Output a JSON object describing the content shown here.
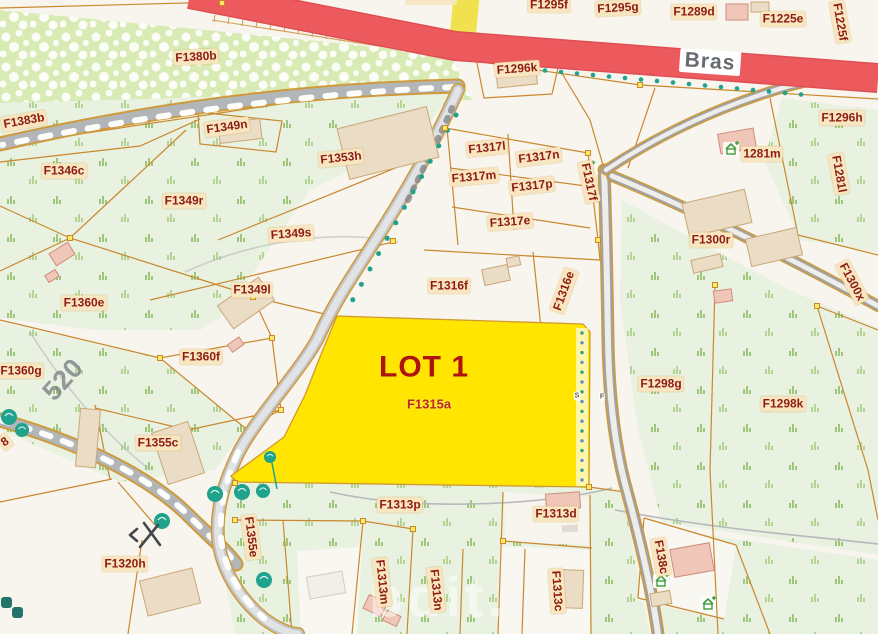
{
  "map": {
    "road_name": "Bras",
    "road_number": "520",
    "lot": {
      "title": "LOT 1",
      "parcel_id": "F1315a"
    },
    "watermark": "bdit.",
    "colors": {
      "lot_fill": "#ffe500",
      "road_major": "#ec5a5e",
      "road_minor_fill": "#d2d5d6",
      "parcel_line": "#c9882e",
      "label_text": "#8e1c12",
      "label_bg": "#f7e6c0",
      "tree": "#1fa38c",
      "grass_bg": "#e9f1e1",
      "orchard_bg": "#d8ebb4",
      "yellow_road": "#f2e14e"
    },
    "icon_names": [
      "tree-icon",
      "house-plus-icon",
      "windmill-icon",
      "survey-marker-icon"
    ],
    "labels": [
      {
        "t": "F1295f",
        "x": 549,
        "y": 5
      },
      {
        "t": "F1295g",
        "x": 618,
        "y": 8,
        "r": -3
      },
      {
        "t": "F1289d",
        "x": 694,
        "y": 12
      },
      {
        "t": "F1225e",
        "x": 783,
        "y": 19
      },
      {
        "t": "F1225f",
        "x": 840,
        "y": 22,
        "r": 80
      },
      {
        "t": "F1296k",
        "x": 517,
        "y": 69,
        "r": -4
      },
      {
        "t": "F1296h",
        "x": 842,
        "y": 118
      },
      {
        "t": "F1380b",
        "x": 196,
        "y": 57,
        "r": -3
      },
      {
        "t": "F1383b",
        "x": 24,
        "y": 121,
        "r": -10
      },
      {
        "t": "F1349n",
        "x": 227,
        "y": 127,
        "r": -8
      },
      {
        "t": "F1353h",
        "x": 341,
        "y": 158,
        "r": -6
      },
      {
        "t": "F1317l",
        "x": 487,
        "y": 148,
        "r": -6
      },
      {
        "t": "F1317n",
        "x": 539,
        "y": 157,
        "r": -7
      },
      {
        "t": "F1317m",
        "x": 474,
        "y": 177,
        "r": -5
      },
      {
        "t": "F1317p",
        "x": 532,
        "y": 186,
        "r": -6
      },
      {
        "t": "F1317f",
        "x": 589,
        "y": 182,
        "r": 78
      },
      {
        "t": "F1317e",
        "x": 510,
        "y": 222,
        "r": -4
      },
      {
        "t": "1281m",
        "x": 762,
        "y": 154
      },
      {
        "t": "F1281l",
        "x": 839,
        "y": 174,
        "r": 80
      },
      {
        "t": "F1300r",
        "x": 711,
        "y": 240
      },
      {
        "t": "F1300x",
        "x": 852,
        "y": 282,
        "r": 62
      },
      {
        "t": "F1346c",
        "x": 64,
        "y": 171
      },
      {
        "t": "F1349r",
        "x": 184,
        "y": 201
      },
      {
        "t": "F1349s",
        "x": 291,
        "y": 234,
        "r": -4
      },
      {
        "t": "F1349l",
        "x": 252,
        "y": 290
      },
      {
        "t": "F1360e",
        "x": 84,
        "y": 303
      },
      {
        "t": "F1360g",
        "x": 21,
        "y": 371
      },
      {
        "t": "F1360f",
        "x": 201,
        "y": 357
      },
      {
        "t": "F1316f",
        "x": 449,
        "y": 286
      },
      {
        "t": "F1316e",
        "x": 564,
        "y": 291,
        "r": -70
      },
      {
        "t": "F1298g",
        "x": 661,
        "y": 384
      },
      {
        "t": "F1298k",
        "x": 783,
        "y": 404
      },
      {
        "t": "F1355c",
        "x": 158,
        "y": 443
      },
      {
        "t": "F1355e",
        "x": 251,
        "y": 537,
        "r": 83
      },
      {
        "t": "F1313p",
        "x": 400,
        "y": 505
      },
      {
        "t": "F1313d",
        "x": 556,
        "y": 514
      },
      {
        "t": "F1313m",
        "x": 382,
        "y": 582,
        "r": 84
      },
      {
        "t": "F1313n",
        "x": 436,
        "y": 590,
        "r": 84
      },
      {
        "t": "F1313c",
        "x": 557,
        "y": 591,
        "r": 86
      },
      {
        "t": "F138c",
        "x": 661,
        "y": 557,
        "r": 80
      },
      {
        "t": "F1320h",
        "x": 125,
        "y": 564
      },
      {
        "t": "8",
        "x": 5,
        "y": 442,
        "r": -35
      },
      {
        "t": "S",
        "x": 577,
        "y": 396,
        "s": "tiny"
      },
      {
        "t": "F",
        "x": 602,
        "y": 397,
        "s": "tiny"
      }
    ]
  }
}
